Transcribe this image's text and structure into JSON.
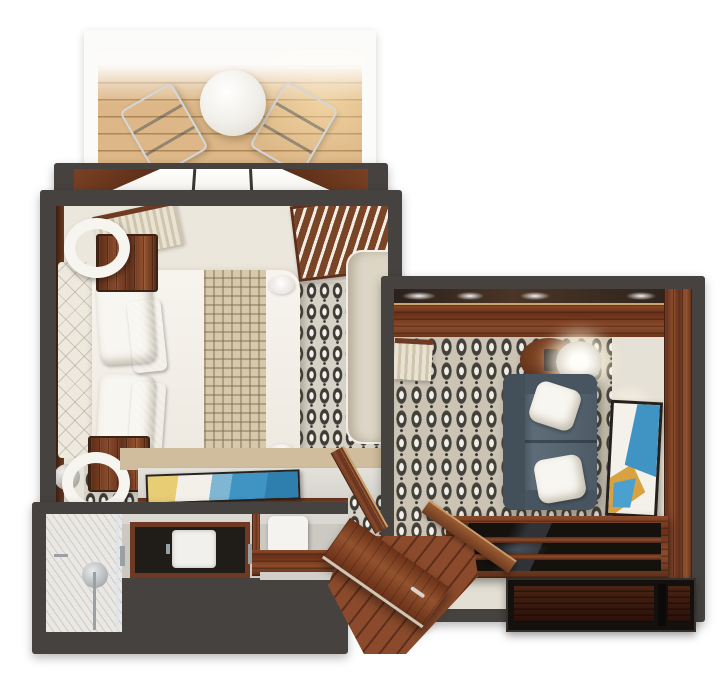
{
  "scene": {
    "title": "Top-down 3D floor plan of a suite with balcony, bedroom, living room, bathroom and entry hall",
    "type": "floorplan-render",
    "rooms": [
      {
        "id": "balcony",
        "label": "Balcony",
        "furniture": [
          "round table",
          "two deck chairs",
          "wood decking",
          "white railing"
        ]
      },
      {
        "id": "bedroom",
        "label": "Bedroom",
        "furniture": [
          "double bed",
          "quilted headboard",
          "white pillows",
          "tan accent pillows",
          "checkered bed runner",
          "two nightstands with ring lamps",
          "patterned carpet",
          "curtains",
          "louvered wardrobe",
          "desk with flat artwork",
          "TV panel",
          "open door"
        ]
      },
      {
        "id": "living-room",
        "label": "Living room",
        "furniture": [
          "slate corner sofa",
          "two white throw pillows",
          "round side table with drum lamp",
          "abstract wall art",
          "glass-top coffee table",
          "storage console",
          "patterned carpet",
          "wood cabinet band"
        ]
      },
      {
        "id": "bathroom",
        "label": "Bathroom",
        "furniture": [
          "walk-in marble shower",
          "dark stone vanity with white sink",
          "toilet",
          "towel bars"
        ]
      },
      {
        "id": "entry",
        "label": "Entry hall",
        "furniture": [
          "open wooden door",
          "diagonal wood floor",
          "half-wall rail"
        ]
      }
    ]
  },
  "palette": {
    "wall_dark": "#45423f",
    "wood": "#7a4226",
    "deck": "#ddb787",
    "carpet_base": "#d7d2c8",
    "carpet_motif": "#403c36",
    "bedding_white": "#f6f3ec",
    "sofa_slate": "#56646f",
    "chair_blue": "#7f95a9",
    "accent_blue": "#3f94c4",
    "accent_gold": "#d9a241",
    "marble": "#eae8e4"
  }
}
